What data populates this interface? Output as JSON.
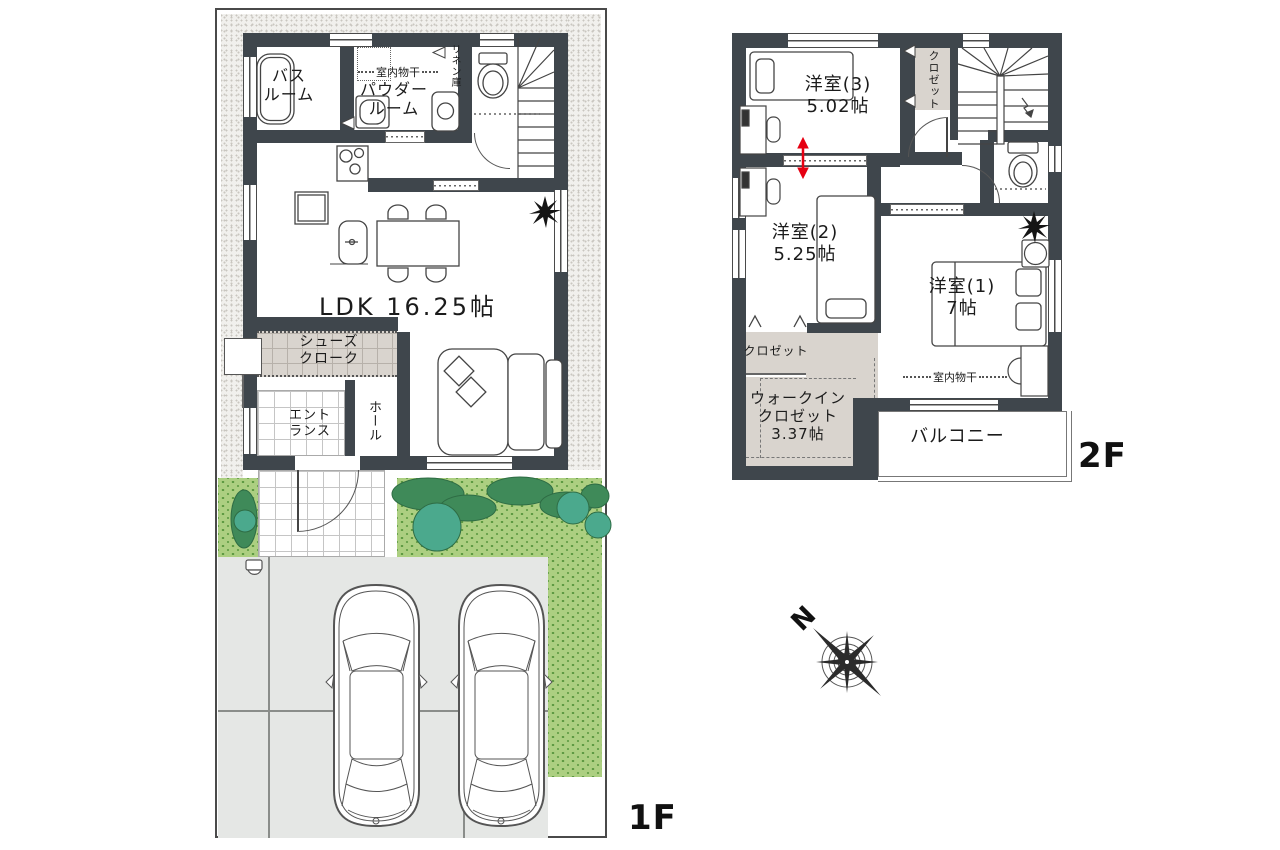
{
  "floor1": {
    "floor_label": "1F",
    "bathroom_l1": "バス",
    "bathroom_l2": "ルーム",
    "powder_l1": "パウダー",
    "powder_l2": "ルーム",
    "indoor_drying": "室内物干",
    "linen_closet": "リネン庫",
    "ldk": "LDK 16.25帖",
    "shoes_closet_l1": "シューズ",
    "shoes_closet_l2": "クローク",
    "entrance_l1": "エント",
    "entrance_l2": "ランス",
    "hall": "ホール"
  },
  "floor2": {
    "floor_label": "2F",
    "room3_name": "洋室(3)",
    "room3_size": "5.02帖",
    "closet_top": "クロゼット",
    "room2_name": "洋室(2)",
    "room2_size": "5.25帖",
    "room1_name": "洋室(1)",
    "room1_size": "7帖",
    "closet_side": "クロゼット",
    "wic_l1": "ウォークイン",
    "wic_l2": "クロゼット",
    "wic_l3": "3.37帖",
    "indoor_drying": "室内物干",
    "balcony": "バルコニー"
  },
  "compass": {
    "north": "N"
  },
  "icons": {
    "compass": "compass-rose-icon",
    "plants": "plant-icon",
    "cars": "car-top-view-icon"
  },
  "colors": {
    "wall": "#3F464C",
    "closet_fill": "#D9D4CE",
    "grass": "#ACCF81",
    "tree": "#4BA98D",
    "bush": "#3F8A59",
    "driveway": "#E5E7E5",
    "partition_arrow": "#E60012"
  }
}
